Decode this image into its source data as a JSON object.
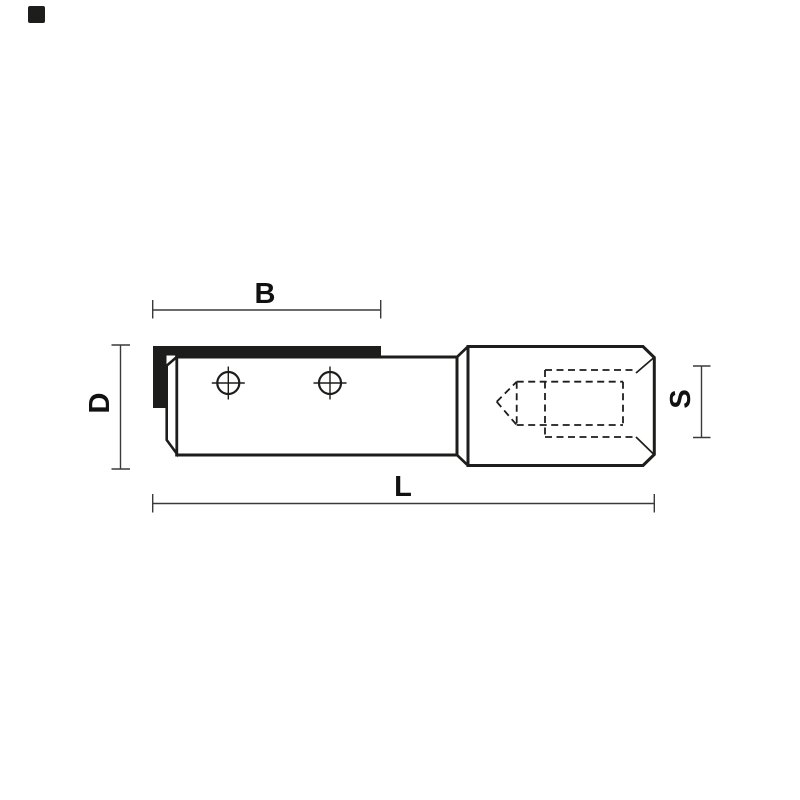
{
  "diagram": {
    "title": "tool-dimension-drawing",
    "labels": {
      "b": "B",
      "d": "D",
      "l": "L",
      "s": "S"
    },
    "colors": {
      "line": "#1d1d1b",
      "dimension_line": "#3a3a3a",
      "background": "#ffffff",
      "cutting_edge": "#1d1d1b",
      "logo": "#121212"
    }
  }
}
